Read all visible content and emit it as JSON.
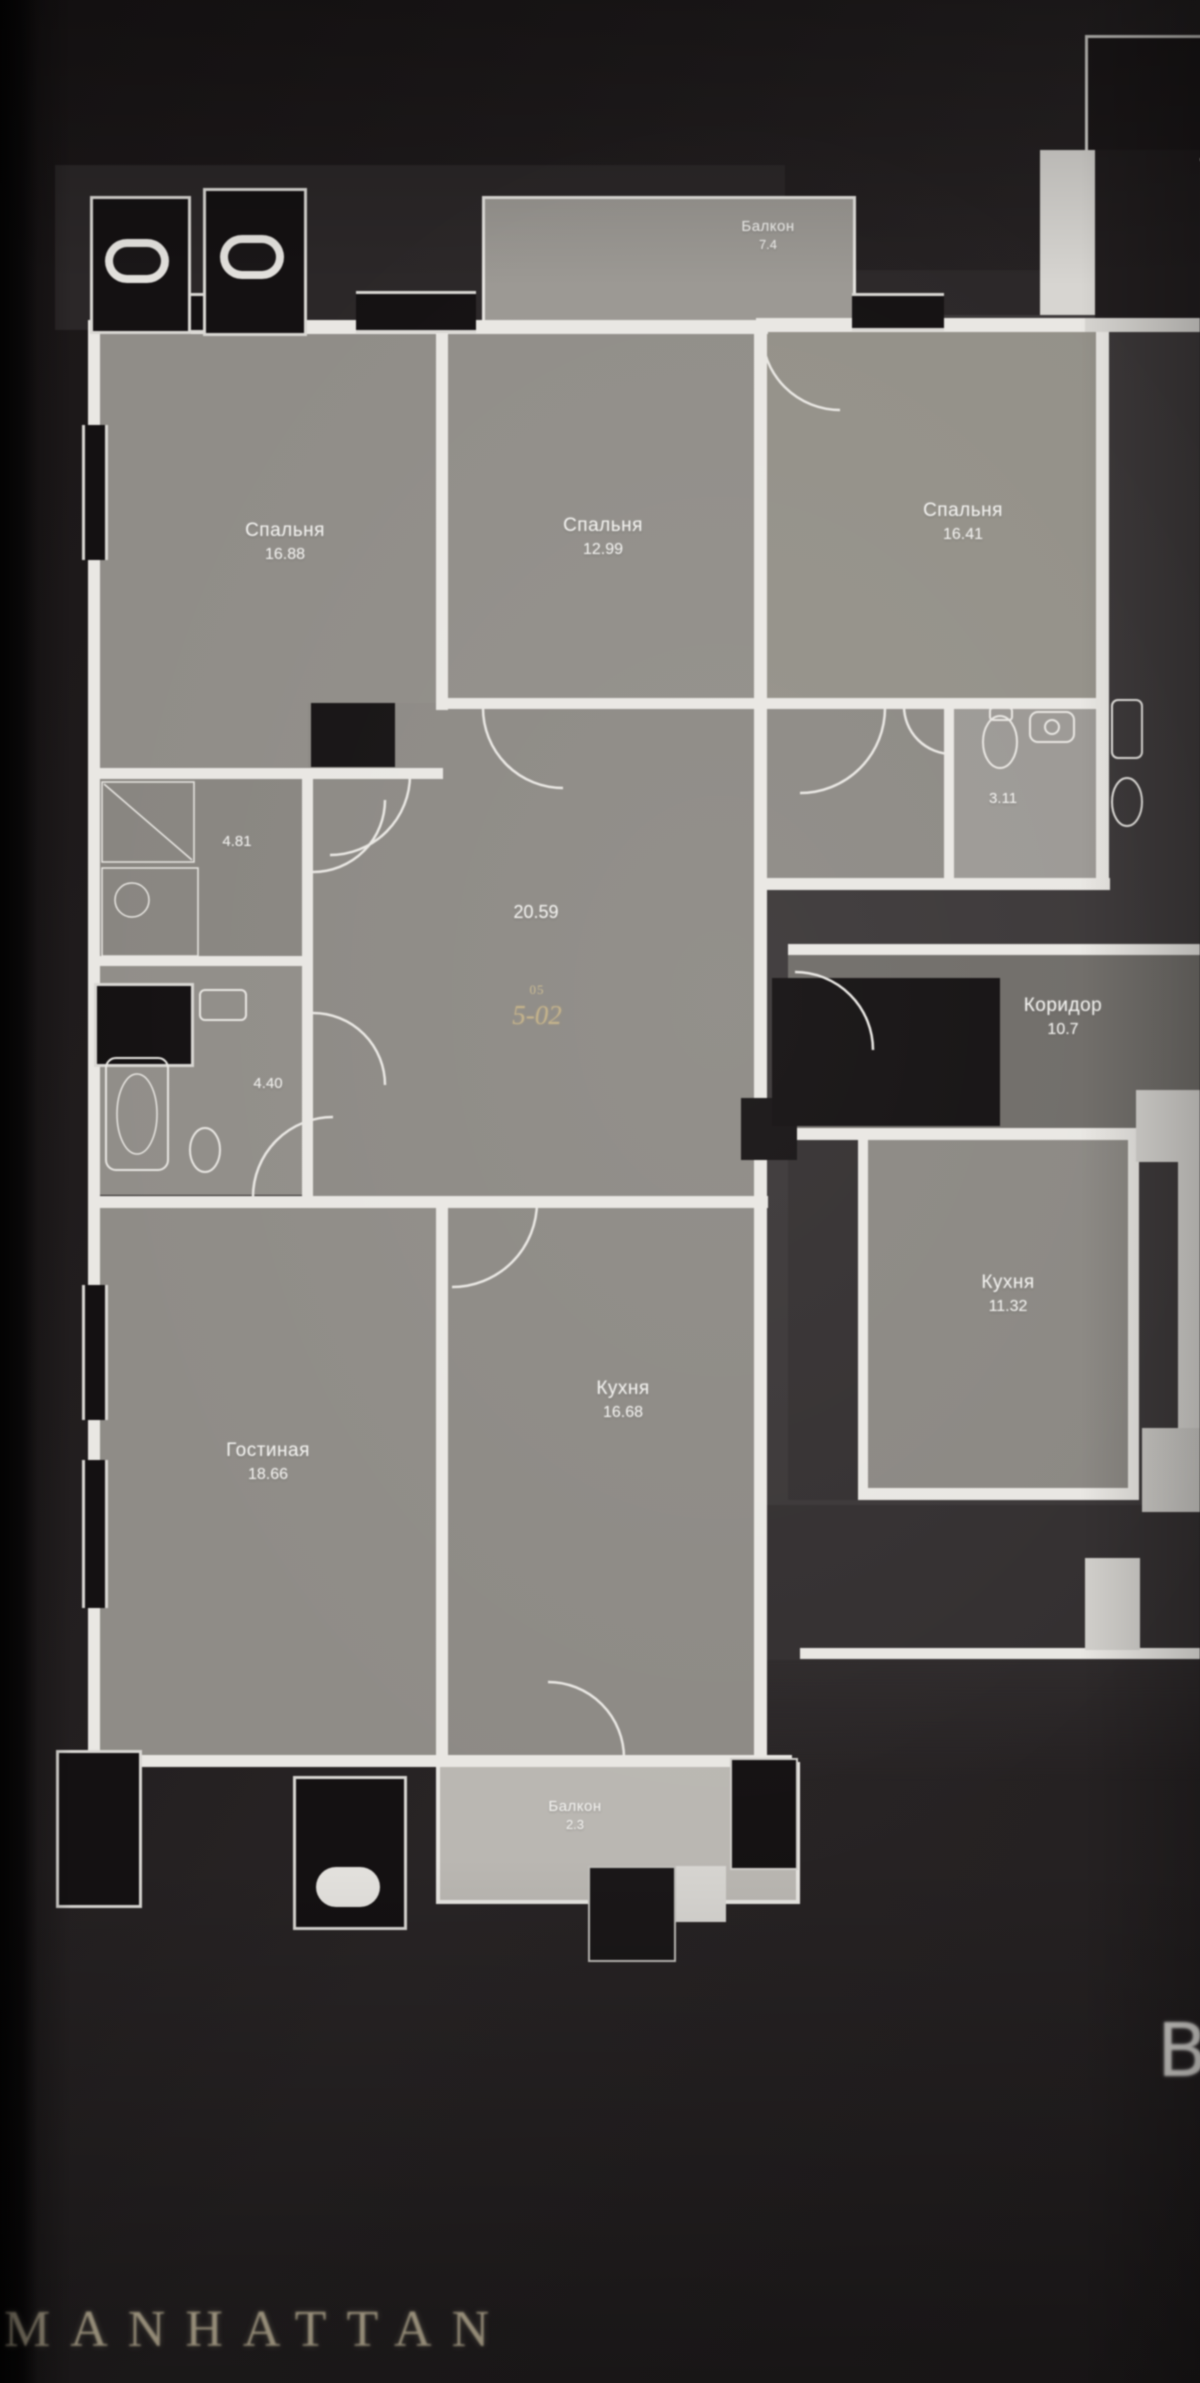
{
  "page": {
    "brand": "MANHATTAN",
    "block_letter": "B"
  },
  "unit": {
    "number_label": "05",
    "number": "5-02",
    "hall_area": "20.59"
  },
  "rooms": {
    "bedroom1": {
      "name": "Спальня",
      "area": "16.88"
    },
    "bedroom2": {
      "name": "Спальня",
      "area": "12.99"
    },
    "bedroom3": {
      "name": "Спальня",
      "area": "16.41"
    },
    "living": {
      "name": "Гостиная",
      "area": "18.66"
    },
    "kitchen": {
      "name": "Кухня",
      "area": "16.68"
    },
    "balcony_top": {
      "name": "Балкон",
      "area": "7.4"
    },
    "balcony_bottom": {
      "name": "Балкон",
      "area": "2.3"
    },
    "storage": {
      "area": "4.81"
    },
    "bathroom": {
      "area": "4.40"
    },
    "wc": {
      "area": "3.11"
    },
    "corridor_neighbor": {
      "name": "Коридор",
      "area": "10.7"
    },
    "kitchen_neighbor": {
      "name": "Кухня",
      "area": "11.32"
    }
  },
  "colors": {
    "background": "#201c1d",
    "room_fill": "#8e8b86",
    "wall": "#e9e7e3",
    "dark_block": "#141112",
    "gold_accent": "#c2b088",
    "brand_gold": "#d8cbae"
  }
}
